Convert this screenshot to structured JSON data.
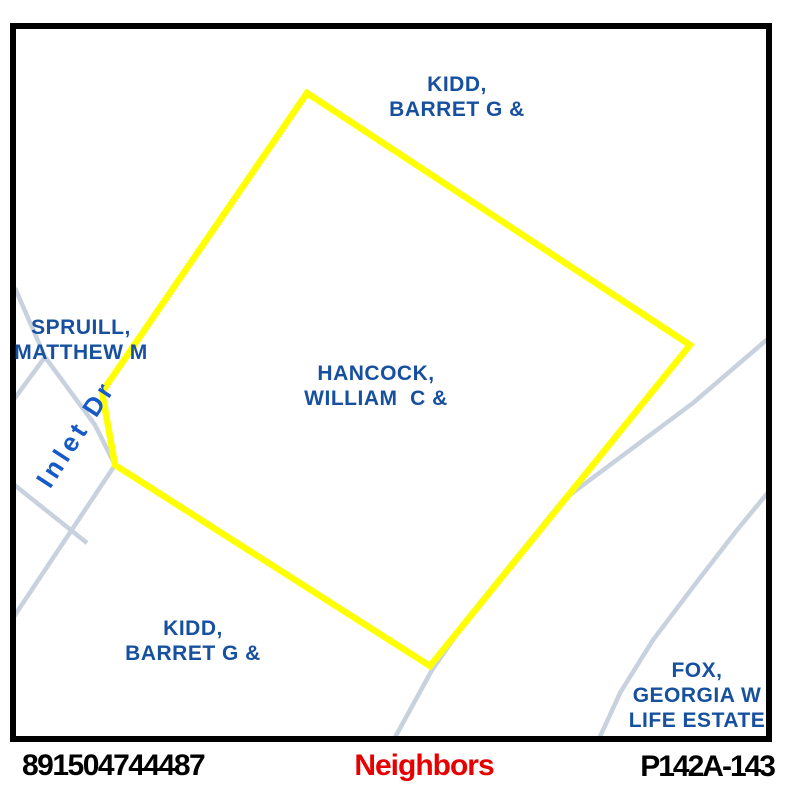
{
  "map": {
    "background": "#FFFFFF",
    "frame_color": "#000000",
    "label_color": "#17509F",
    "parcel": {
      "owner": "HANCOCK, WILLIAM C &",
      "outline_color": "#FFFF00",
      "outline_width": 6.5,
      "points": "307,93 690,345 430,666 115,465 102,392"
    },
    "roads": {
      "color": "#C8D2DF",
      "width": 4.5,
      "lines": [
        "15,288 45,357 95,425 115,465 13,618",
        "45,357 12,402",
        "12,483 87,543",
        "770,337 693,403 563,500 470,615 432,670 393,741",
        "770,490 737,530 693,587 653,640 620,693 598,741"
      ]
    },
    "road_label": {
      "text": "Inlet Dr",
      "color": "#1659C8",
      "x": 76,
      "y": 434,
      "angle": -57
    },
    "labels": [
      {
        "name": "kidd-north",
        "text": "KIDD,\nBARRET G &",
        "x": 457,
        "y": 72
      },
      {
        "name": "spruill",
        "text": "SPRUILL,\nMATTHEW M",
        "x": 81,
        "y": 315
      },
      {
        "name": "hancock",
        "text": "HANCOCK,\nWILLIAM  C &",
        "x": 376,
        "y": 361
      },
      {
        "name": "kidd-south",
        "text": "KIDD,\nBARRET G &",
        "x": 193,
        "y": 616
      },
      {
        "name": "fox",
        "text": "FOX,\nGEORGIA W\nLIFE ESTATE",
        "x": 697,
        "y": 658
      }
    ]
  },
  "footer": {
    "parcel_id": "891504744487",
    "view_label": "Neighbors",
    "view_label_color": "#E60000",
    "sheet": "P142A-143"
  }
}
